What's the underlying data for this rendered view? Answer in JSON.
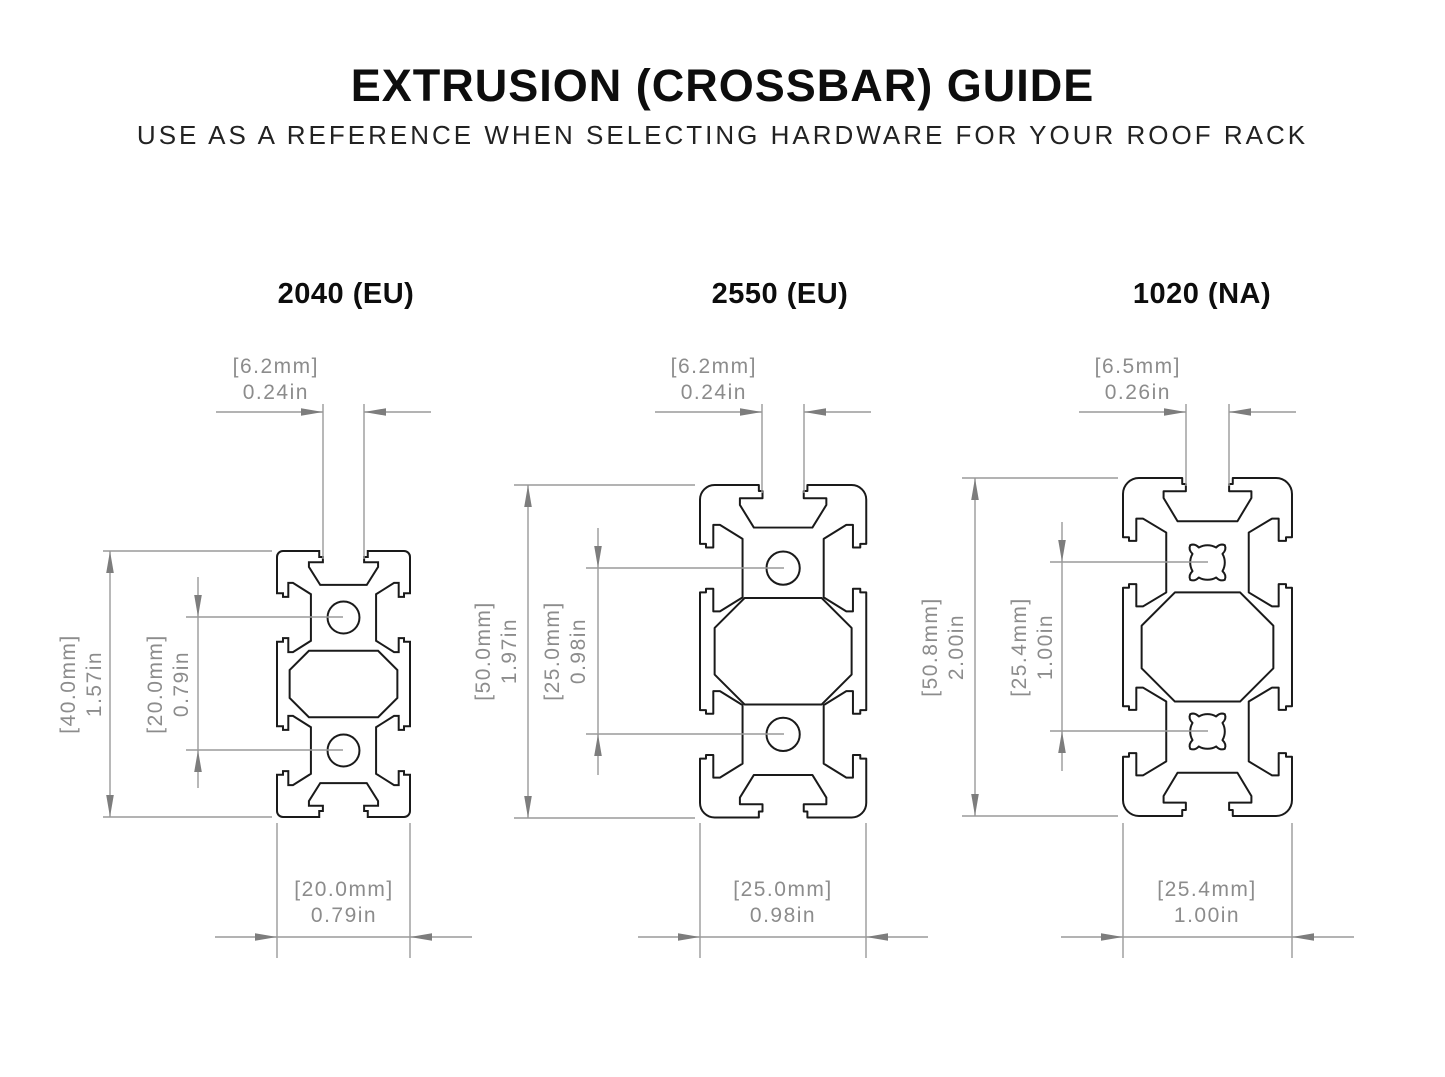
{
  "title": "EXTRUSION (CROSSBAR) GUIDE",
  "subtitle": "USE AS A REFERENCE WHEN SELECTING HARDWARE FOR YOUR ROOF RACK",
  "colors": {
    "drawing_line": "#1a1a1a",
    "dimension_line": "#9a9a9a",
    "dimension_arrow": "#7d7d7d",
    "dimension_text": "#8c8c8c"
  },
  "profiles": [
    {
      "name": "2040 (EU)",
      "slot_width": {
        "mm": "[6.2mm]",
        "in": "0.24in"
      },
      "height": {
        "mm": "[40.0mm]",
        "in": "1.57in"
      },
      "hole_spacing": {
        "mm": "[20.0mm]",
        "in": "0.79in"
      },
      "width": {
        "mm": "[20.0mm]",
        "in": "0.79in"
      }
    },
    {
      "name": "2550 (EU)",
      "slot_width": {
        "mm": "[6.2mm]",
        "in": "0.24in"
      },
      "height": {
        "mm": "[50.0mm]",
        "in": "1.97in"
      },
      "hole_spacing": {
        "mm": "[25.0mm]",
        "in": "0.98in"
      },
      "width": {
        "mm": "[25.0mm]",
        "in": "0.98in"
      }
    },
    {
      "name": "1020 (NA)",
      "slot_width": {
        "mm": "[6.5mm]",
        "in": "0.26in"
      },
      "height": {
        "mm": "[50.8mm]",
        "in": "2.00in"
      },
      "hole_spacing": {
        "mm": "[25.4mm]",
        "in": "1.00in"
      },
      "width": {
        "mm": "[25.4mm]",
        "in": "1.00in"
      }
    }
  ]
}
